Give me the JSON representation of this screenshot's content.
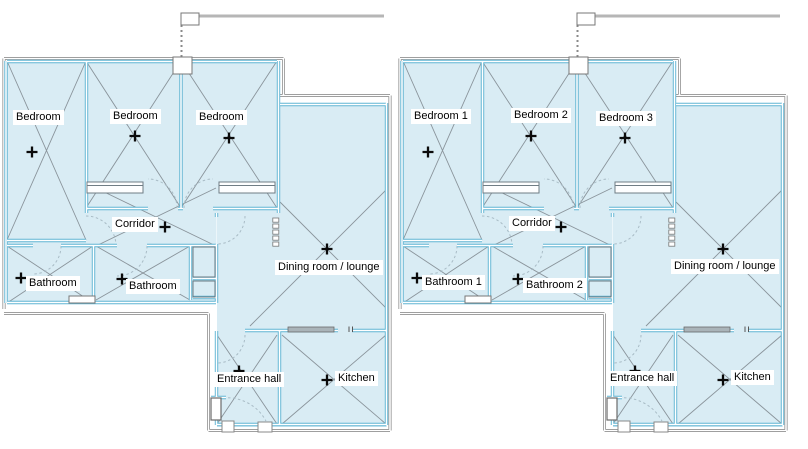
{
  "figure": {
    "type": "floor-plan-comparison",
    "description": "Two identical apartment floor plans side by side; left plan has unnumbered room labels, right plan has numbered room labels."
  },
  "plans": {
    "left": {
      "rooms": {
        "bedroom_1": "Bedroom",
        "bedroom_2": "Bedroom",
        "bedroom_3": "Bedroom",
        "corridor": "Corridor",
        "bathroom_1": "Bathroom",
        "bathroom_2": "Bathroom",
        "dining": "Dining room / lounge",
        "entrance": "Entrance hall",
        "kitchen": "Kitchen"
      }
    },
    "right": {
      "rooms": {
        "bedroom_1": "Bedroom 1",
        "bedroom_2": "Bedroom 2",
        "bedroom_3": "Bedroom 3",
        "corridor": "Corridor",
        "bathroom_1": "Bathroom 1",
        "bathroom_2": "Bathroom 2",
        "dining": "Dining room / lounge",
        "entrance": "Entrance hall",
        "kitchen": "Kitchen"
      }
    }
  },
  "colors": {
    "room_fill": "#d9ecf4",
    "wall_line": "#5fb4d2",
    "exterior_line": "#7f7f7f",
    "diagonal_line": "#8a949b",
    "door_arc": "#a9bcc6",
    "marker": "#0a0a0a",
    "label_bg": "#ffffff"
  }
}
